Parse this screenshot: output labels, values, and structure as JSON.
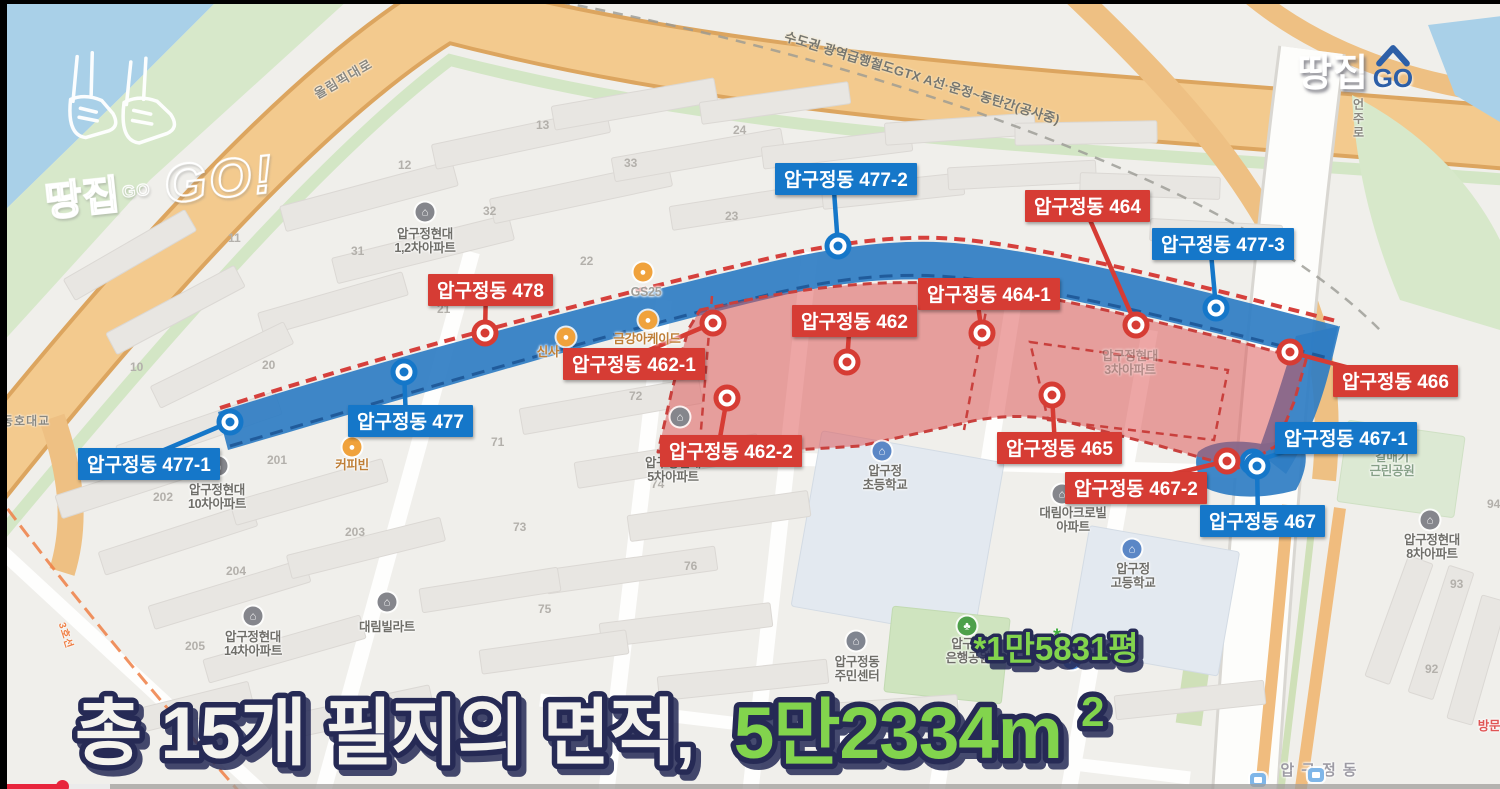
{
  "branding": {
    "stamp_kr": "땅집",
    "stamp_go_small": "GO",
    "stamp_go_big": "GO!",
    "badge_kr": "땅집",
    "badge_go": "GO"
  },
  "gtx_label": "수도권 광역급행철도GTX A선·운정~동탄간(공사중)",
  "headline": {
    "white": "총 15개 필지의 면적,",
    "green": "5만2334m",
    "sup": "2",
    "note": "*1만5831평"
  },
  "colors": {
    "red": "#d63c34",
    "blue": "#1577c9",
    "band_blue": "#2f7dc3",
    "red_fill": "rgba(219,78,78,0.5)",
    "green_text": "#82d44e",
    "outline_navy": "#252a55"
  },
  "road_labels": [
    {
      "text": "올림픽대로",
      "x": 310,
      "y": 86,
      "rot": -30
    },
    {
      "text": "언주로",
      "x": 1350,
      "y": 98,
      "vertical": true
    },
    {
      "text": "동호대교",
      "x": 2,
      "y": 412,
      "small": true
    },
    {
      "text": "3호선",
      "x": 70,
      "y": 620,
      "rot": 72,
      "line3": true
    }
  ],
  "parcels": [
    {
      "label": "압구정동 477-2",
      "color": "blue",
      "lx": 775,
      "ly": 163,
      "mx": 838,
      "my": 246
    },
    {
      "label": "압구정동 464",
      "color": "red",
      "lx": 1025,
      "ly": 190,
      "mx": 1136,
      "my": 325
    },
    {
      "label": "압구정동 477-3",
      "color": "blue",
      "lx": 1152,
      "ly": 228,
      "mx": 1216,
      "my": 308
    },
    {
      "label": "압구정동 478",
      "color": "red",
      "lx": 428,
      "ly": 274,
      "mx": 485,
      "my": 333
    },
    {
      "label": "압구정동 464-1",
      "color": "red",
      "lx": 918,
      "ly": 278,
      "mx": 982,
      "my": 333
    },
    {
      "label": "압구정동 462",
      "color": "red",
      "lx": 792,
      "ly": 305,
      "mx": 847,
      "my": 362
    },
    {
      "label": "압구정동 462-1",
      "color": "red",
      "lx": 563,
      "ly": 348,
      "mx": 713,
      "my": 323
    },
    {
      "label": "압구정동 477",
      "color": "blue",
      "lx": 348,
      "ly": 405,
      "mx": 404,
      "my": 372
    },
    {
      "label": "압구정동 466",
      "color": "red",
      "lx": 1333,
      "ly": 365,
      "mx": 1290,
      "my": 352
    },
    {
      "label": "압구정동 462-2",
      "color": "red",
      "lx": 660,
      "ly": 435,
      "mx": 727,
      "my": 398
    },
    {
      "label": "압구정동 477-1",
      "color": "blue",
      "lx": 78,
      "ly": 448,
      "mx": 230,
      "my": 422
    },
    {
      "label": "압구정동 465",
      "color": "red",
      "lx": 997,
      "ly": 432,
      "mx": 1052,
      "my": 395
    },
    {
      "label": "압구정동 467-1",
      "color": "blue",
      "lx": 1275,
      "ly": 422,
      "mx": 1253,
      "my": 462
    },
    {
      "label": "압구정동 467-2",
      "color": "red",
      "lx": 1065,
      "ly": 472,
      "mx": 1227,
      "my": 461
    },
    {
      "label": "압구정동 467",
      "color": "blue",
      "lx": 1200,
      "ly": 505,
      "mx": 1257,
      "my": 466
    }
  ],
  "pois": [
    {
      "lines": [
        "압구정현대",
        "1,2차아파트"
      ],
      "x": 425,
      "y": 241,
      "icon": "house",
      "ix": 425,
      "iy": 212
    },
    {
      "lines": [
        "압구정현대",
        "5차아파트"
      ],
      "x": 673,
      "y": 470,
      "icon": "house",
      "ix": 680,
      "iy": 417
    },
    {
      "lines": [
        "압구정현대",
        "10차아파트"
      ],
      "x": 217,
      "y": 497,
      "icon": "house",
      "ix": 218,
      "iy": 466
    },
    {
      "lines": [
        "압구정현대",
        "14차아파트"
      ],
      "x": 253,
      "y": 644,
      "icon": "house",
      "ix": 253,
      "iy": 616
    },
    {
      "lines": [
        "대림빌라트"
      ],
      "x": 387,
      "y": 627,
      "icon": "house",
      "ix": 387,
      "iy": 602
    },
    {
      "lines": [
        "대림아크로빌",
        "아파트"
      ],
      "x": 1073,
      "y": 520,
      "icon": "house",
      "ix": 1062,
      "iy": 494
    },
    {
      "lines": [
        "압구정현대",
        "3차아파트"
      ],
      "x": 1130,
      "y": 363,
      "cls": "faint"
    },
    {
      "lines": [
        "압구정",
        "초등학교"
      ],
      "x": 885,
      "y": 478,
      "icon": "school",
      "ix": 882,
      "iy": 451
    },
    {
      "lines": [
        "압구정",
        "고등학교"
      ],
      "x": 1133,
      "y": 576,
      "icon": "school",
      "ix": 1132,
      "iy": 549
    },
    {
      "lines": [
        "압구정동",
        "주민센터"
      ],
      "x": 857,
      "y": 669,
      "icon": "office",
      "ix": 856,
      "iy": 641
    },
    {
      "lines": [
        "압구정",
        "은행공원"
      ],
      "x": 968,
      "y": 651,
      "icon": "park",
      "ix": 967,
      "iy": 626
    },
    {
      "lines": [
        "갈매기",
        "근린공원"
      ],
      "x": 1392,
      "y": 464,
      "cls": "park-text"
    },
    {
      "lines": [
        "압구정현대",
        "8차아파트"
      ],
      "x": 1432,
      "y": 547,
      "icon": "house",
      "ix": 1430,
      "iy": 520
    },
    {
      "lines": [
        "커피빈"
      ],
      "x": 352,
      "y": 465,
      "cls": "orange",
      "icon": "shop",
      "ix": 352,
      "iy": 447
    },
    {
      "lines": [
        "GS25"
      ],
      "x": 646,
      "y": 292,
      "cls": "store",
      "icon": "shop",
      "ix": 643,
      "iy": 272
    },
    {
      "lines": [
        "금강아케이드"
      ],
      "x": 647,
      "y": 339,
      "cls": "orange",
      "icon": "shop",
      "ix": 648,
      "iy": 320
    },
    {
      "lines": [
        "신사"
      ],
      "x": 548,
      "y": 352,
      "cls": "orange",
      "icon": "shop",
      "ix": 566,
      "iy": 337
    },
    {
      "lines": [
        "압구정동"
      ],
      "x": 1322,
      "y": 771,
      "cls": "station"
    },
    {
      "lines": [
        "방문"
      ],
      "x": 1489,
      "y": 726,
      "cls": "redtext"
    },
    {
      "lines": [],
      "icon": "parking",
      "ix": 1072,
      "iy": 660
    },
    {
      "lines": [],
      "icon": "aster",
      "ix": 1057,
      "iy": 637
    },
    {
      "lines": [],
      "icon": "subway",
      "ix": 1258,
      "iy": 780
    },
    {
      "lines": [],
      "icon": "subway",
      "ix": 1316,
      "iy": 775
    }
  ],
  "block_numbers": [
    {
      "n": "10",
      "x": 130,
      "y": 371
    },
    {
      "n": "11",
      "x": 228,
      "y": 242
    },
    {
      "n": "12",
      "x": 398,
      "y": 169
    },
    {
      "n": "13",
      "x": 536,
      "y": 129
    },
    {
      "n": "20",
      "x": 262,
      "y": 369
    },
    {
      "n": "21",
      "x": 437,
      "y": 313
    },
    {
      "n": "22",
      "x": 580,
      "y": 265
    },
    {
      "n": "23",
      "x": 725,
      "y": 220
    },
    {
      "n": "24",
      "x": 733,
      "y": 134
    },
    {
      "n": "31",
      "x": 351,
      "y": 255
    },
    {
      "n": "32",
      "x": 483,
      "y": 215
    },
    {
      "n": "33",
      "x": 624,
      "y": 167
    },
    {
      "n": "71",
      "x": 491,
      "y": 446
    },
    {
      "n": "72",
      "x": 629,
      "y": 400
    },
    {
      "n": "73",
      "x": 513,
      "y": 531
    },
    {
      "n": "74",
      "x": 651,
      "y": 488
    },
    {
      "n": "75",
      "x": 538,
      "y": 613
    },
    {
      "n": "76",
      "x": 684,
      "y": 570
    },
    {
      "n": "201",
      "x": 267,
      "y": 464
    },
    {
      "n": "202",
      "x": 153,
      "y": 501
    },
    {
      "n": "203",
      "x": 345,
      "y": 536
    },
    {
      "n": "204",
      "x": 226,
      "y": 575
    },
    {
      "n": "205",
      "x": 185,
      "y": 650
    },
    {
      "n": "92",
      "x": 1425,
      "y": 673
    },
    {
      "n": "93",
      "x": 1450,
      "y": 588
    },
    {
      "n": "94",
      "x": 1487,
      "y": 508
    }
  ]
}
